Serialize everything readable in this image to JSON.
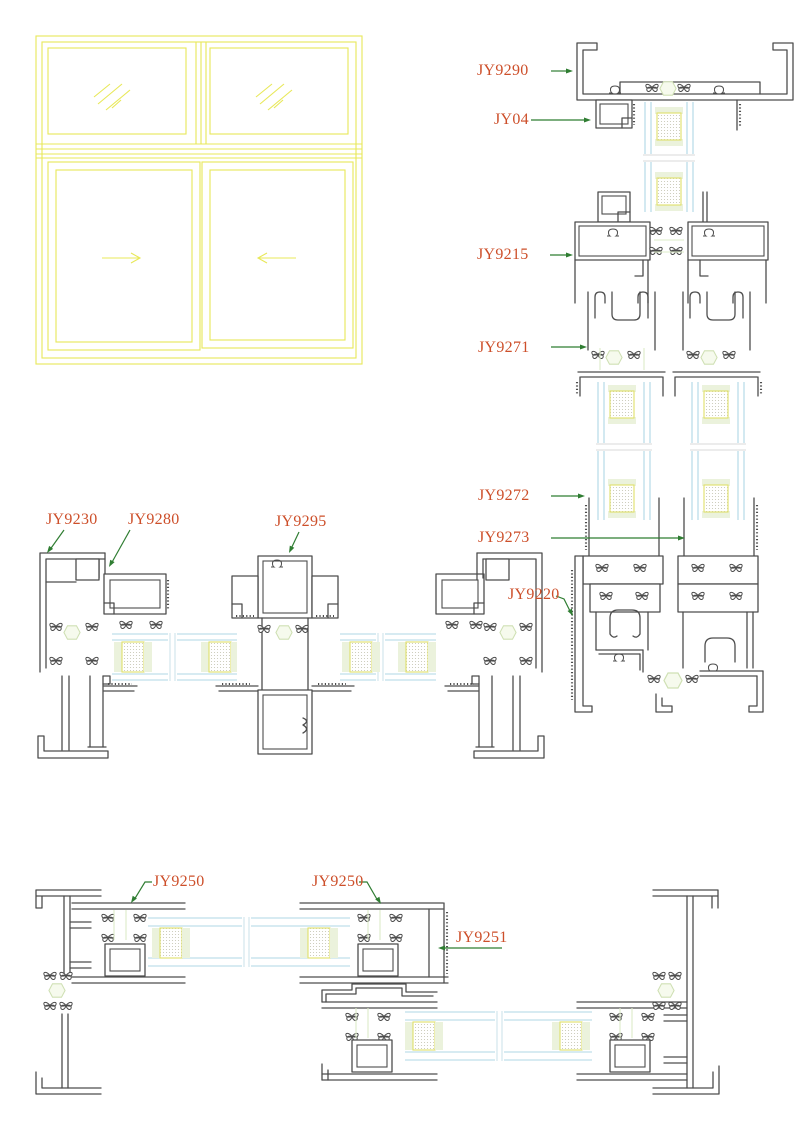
{
  "sheet": {
    "description": "Aluminium sliding window profile section details",
    "colors": {
      "background": "#ffffff",
      "label_text": "#cd4f2a",
      "leader_line": "#2f7d32",
      "profile_line": "#4d4d4d",
      "elevation_line": "#e8e858",
      "glass_line": "#afd7e5",
      "spacer_border": "#dfdf6a",
      "sealant_fill": "#ebf2dc",
      "boss_outline": "#cfe0b4"
    }
  },
  "elevation": {
    "icons": [
      "glass-hatch-icon",
      "slide-arrow-right-icon",
      "slide-arrow-left-icon"
    ]
  },
  "labels": {
    "jy9290": "JY9290",
    "jy04": "JY04",
    "jy9215": "JY9215",
    "jy9271": "JY9271",
    "jy9272": "JY9272",
    "jy9273": "JY9273",
    "jy9220": "JY9220",
    "jy9230": "JY9230",
    "jy9280": "JY9280",
    "jy9295": "JY9295",
    "jy9250_left": "JY9250",
    "jy9250_right": "JY9250",
    "jy9251": "JY9251"
  }
}
